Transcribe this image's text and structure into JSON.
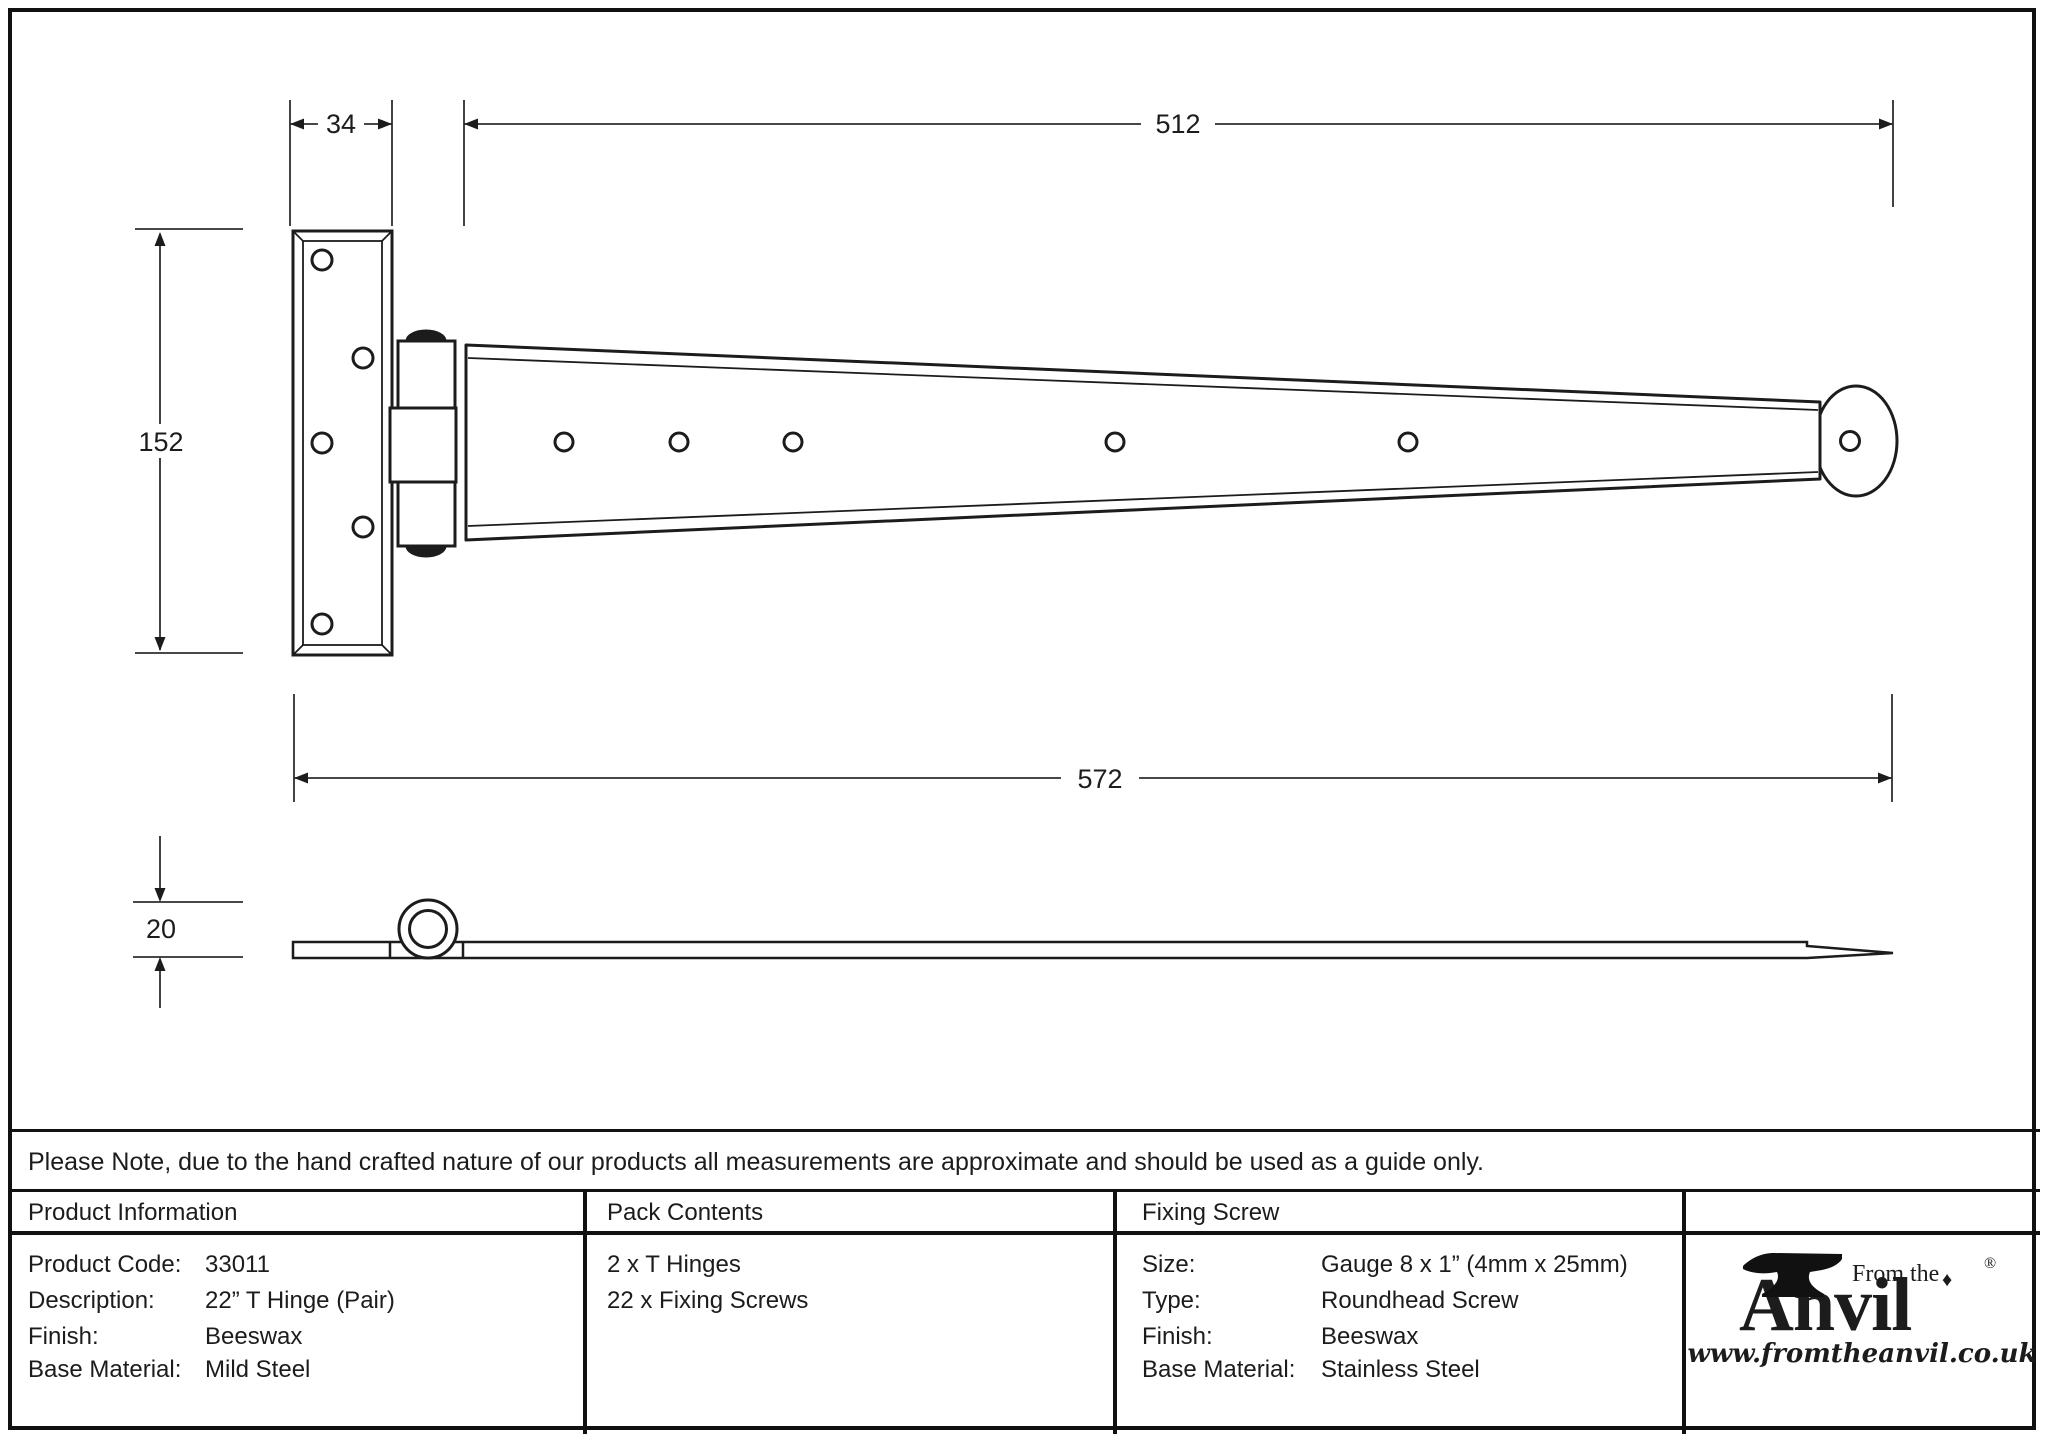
{
  "note": "Please Note, due to the hand crafted nature of our products all measurements are approximate and should be used as a guide only.",
  "drawing": {
    "dims": {
      "plate_width": "34",
      "strap_length": "512",
      "plate_height": "152",
      "overall_length": "572",
      "thickness": "20"
    }
  },
  "table": {
    "product_info": {
      "header": "Product Information",
      "rows": [
        {
          "label": "Product Code:",
          "value": "33011"
        },
        {
          "label": "Description:",
          "value": "22” T Hinge (Pair)"
        },
        {
          "label": "Finish:",
          "value": "Beeswax"
        },
        {
          "label": "Base Material:",
          "value": "Mild Steel"
        }
      ]
    },
    "pack_contents": {
      "header": "Pack Contents",
      "items": [
        "2 x T Hinges",
        "22 x Fixing Screws"
      ]
    },
    "fixing_screw": {
      "header": "Fixing Screw",
      "rows": [
        {
          "label": "Size:",
          "value": "Gauge 8 x 1” (4mm x 25mm)"
        },
        {
          "label": "Type:",
          "value": "Roundhead Screw"
        },
        {
          "label": "Finish:",
          "value": "Beeswax"
        },
        {
          "label": "Base Material:",
          "value": "Stainless Steel"
        }
      ]
    }
  },
  "logo": {
    "prefix": "From the",
    "brand": "Anvil",
    "registered": "®",
    "diamond": "♦",
    "url": "www.fromtheanvil.co.uk"
  }
}
